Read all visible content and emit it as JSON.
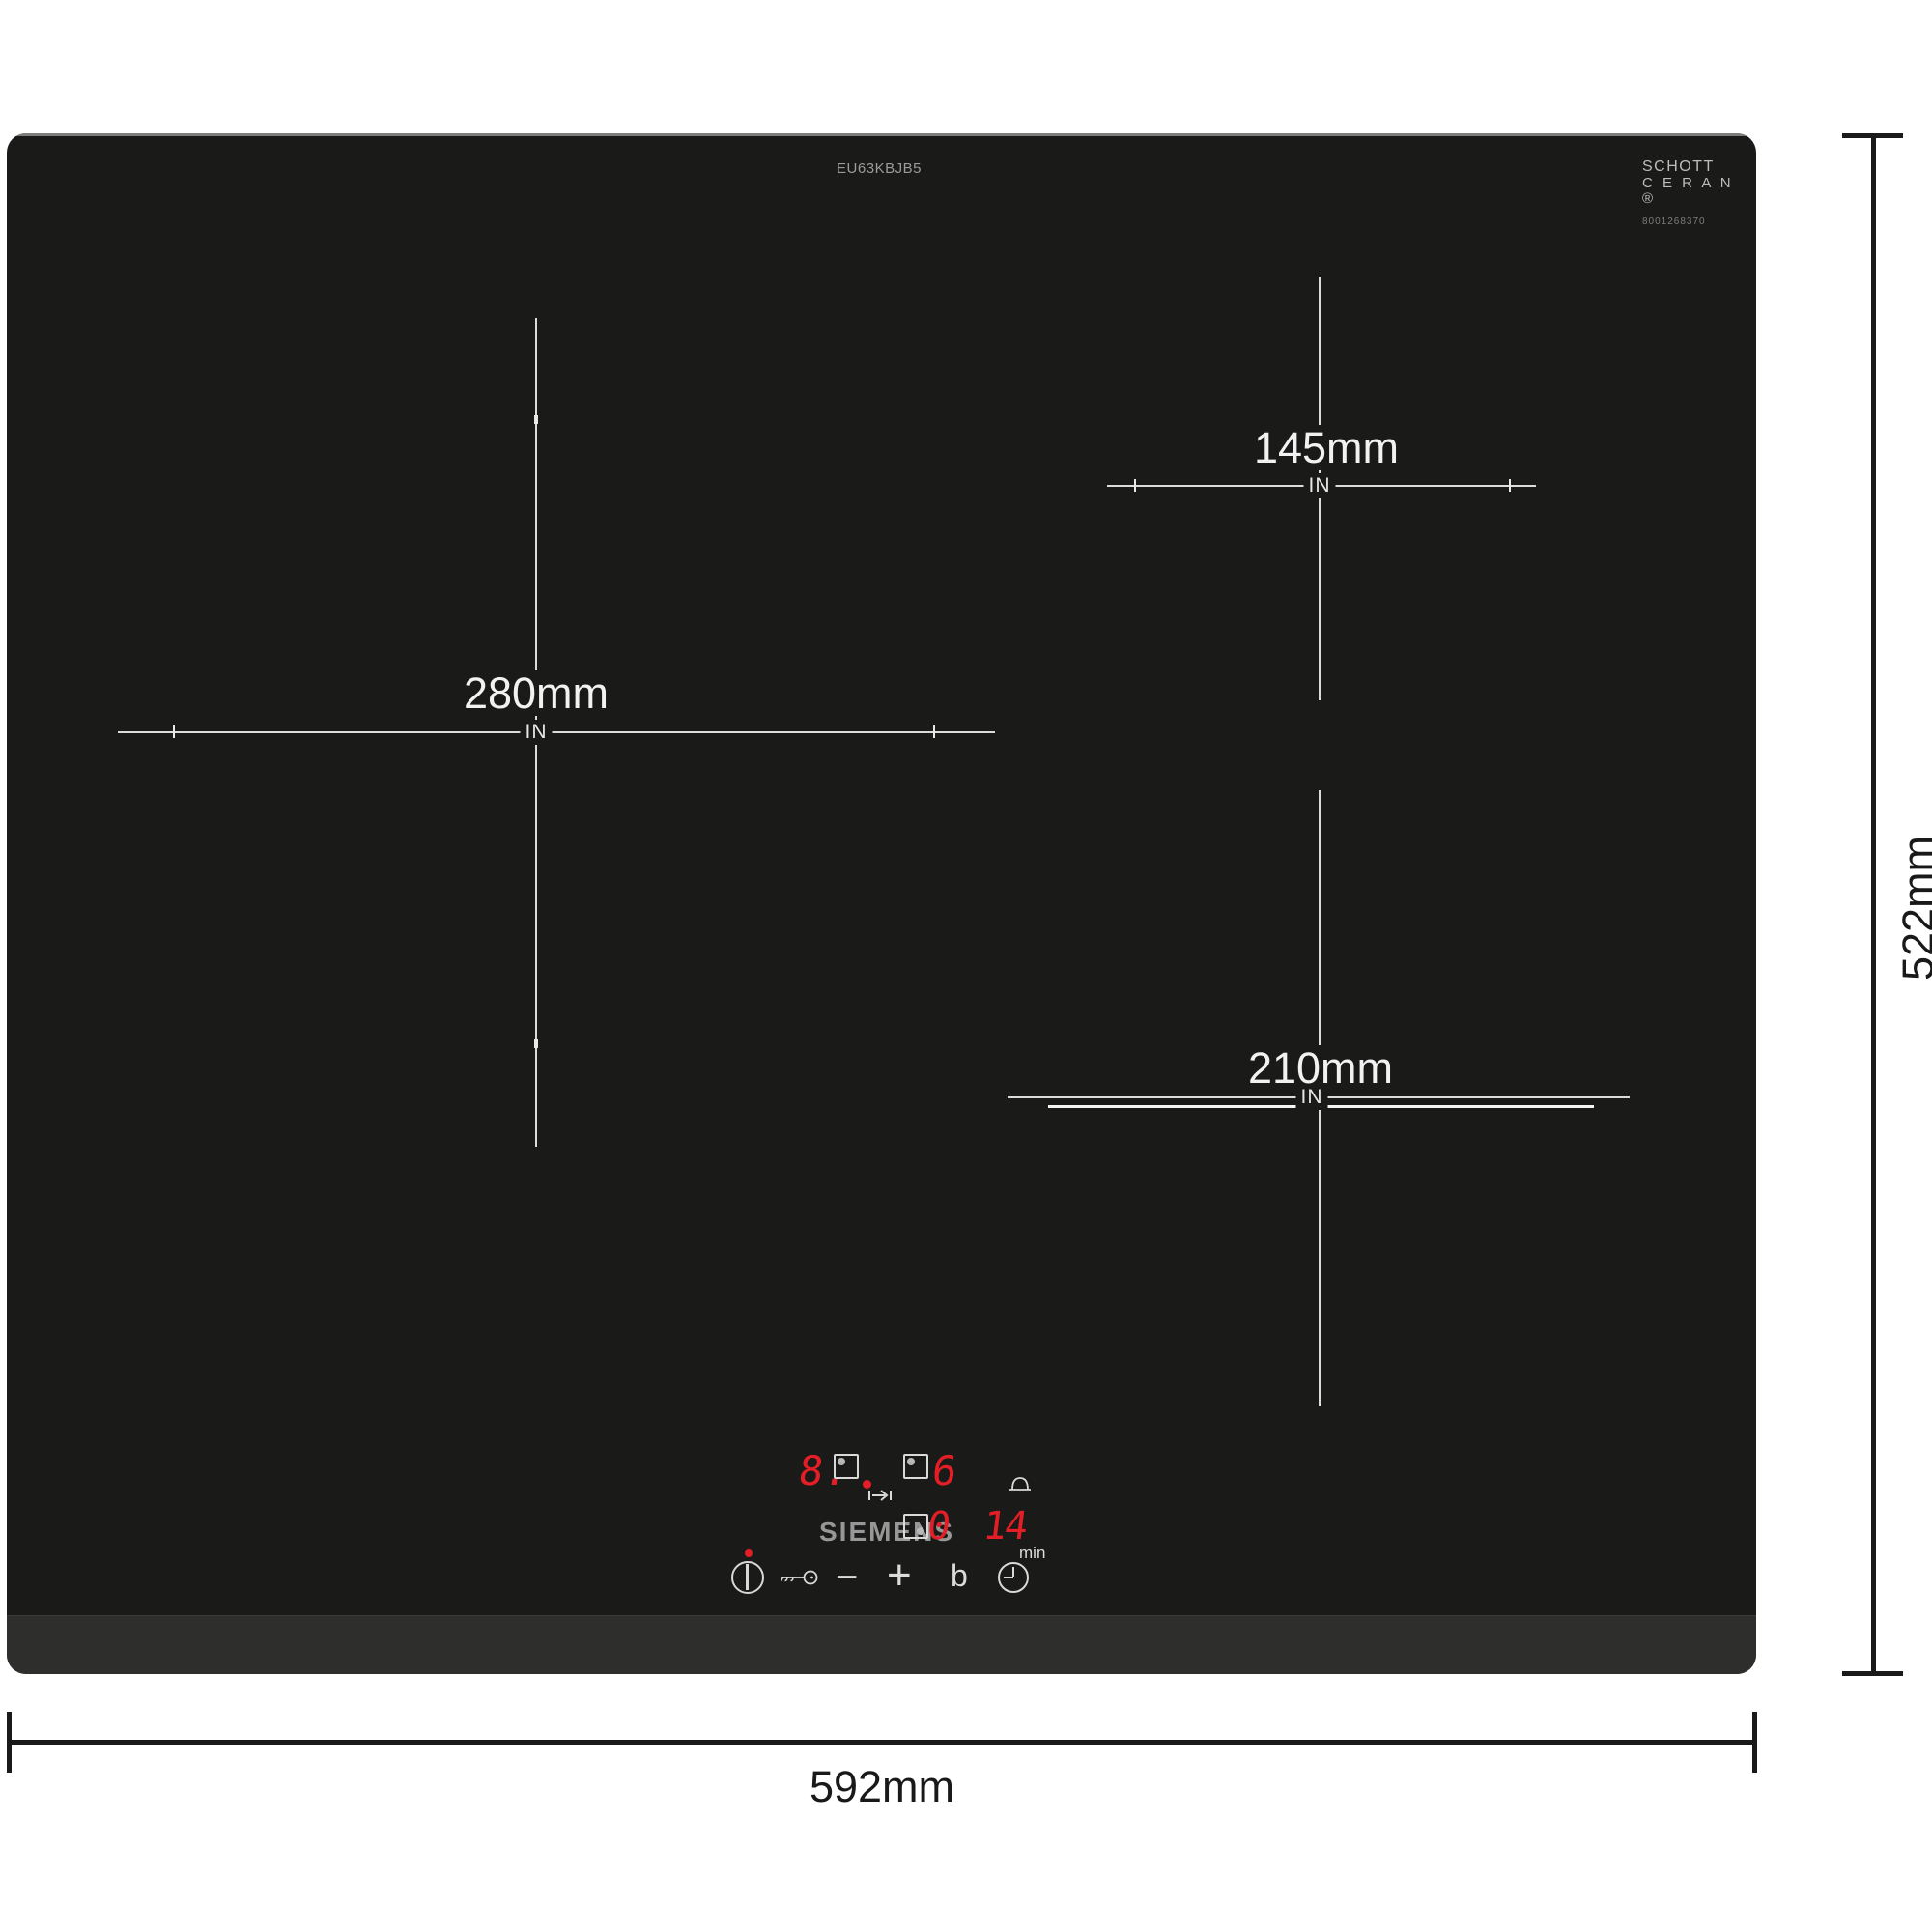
{
  "annotations": {
    "width_label": "592mm",
    "height_label": "522mm"
  },
  "hob": {
    "model": "EU63KBJB5",
    "brand": "SIEMENS",
    "glass_logo": {
      "line1": "SCHOTT",
      "line2": "C E R A N ®",
      "serial": "8001268370"
    }
  },
  "zones": [
    {
      "name": "left-zone",
      "diameter": "280mm",
      "marker": "IN"
    },
    {
      "name": "top-right-zone",
      "diameter": "145mm",
      "marker": "IN"
    },
    {
      "name": "bottom-right-zone",
      "diameter": "210mm",
      "marker": "IN"
    }
  ],
  "control_panel": {
    "display": {
      "left_level": "8.",
      "right_level": "6",
      "timer_zone": "0",
      "timer_min_tens": "1",
      "timer_min_units": "4",
      "timer_unit": "min"
    },
    "buttons": {
      "minus": "−",
      "plus": "+",
      "boost": "b"
    }
  },
  "colors": {
    "hob_body": "#1a1a19",
    "hob_strip": "#2e2e2c",
    "zone_line": "#dcdcdc",
    "led_red": "#e41e26",
    "icon_white": "#d9d9d9",
    "brand_gray": "#979797",
    "dimension_black": "#1a1a1a"
  }
}
